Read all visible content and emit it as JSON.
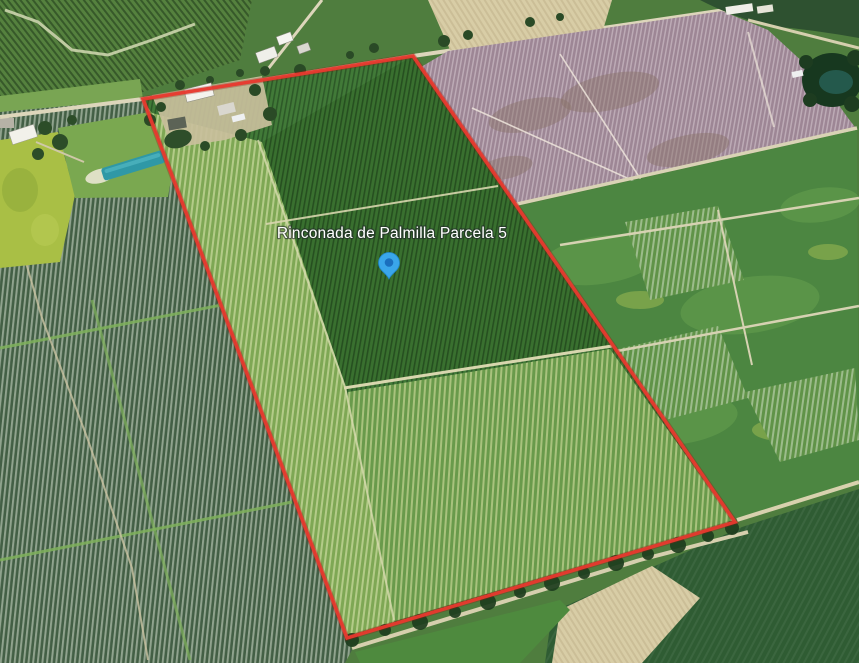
{
  "map": {
    "view_kind": "satellite-aerial-view",
    "parcel_label": "Rinconada de Palmilla Parcela 5",
    "marker": {
      "kind": "location-pin"
    },
    "colors": {
      "boundary": "#e8392e",
      "pin_fill": "#3aa6ea",
      "pin_dot": "#1a6fbe",
      "label_fill": "#ffffff",
      "label_halo": "#23282d"
    }
  }
}
